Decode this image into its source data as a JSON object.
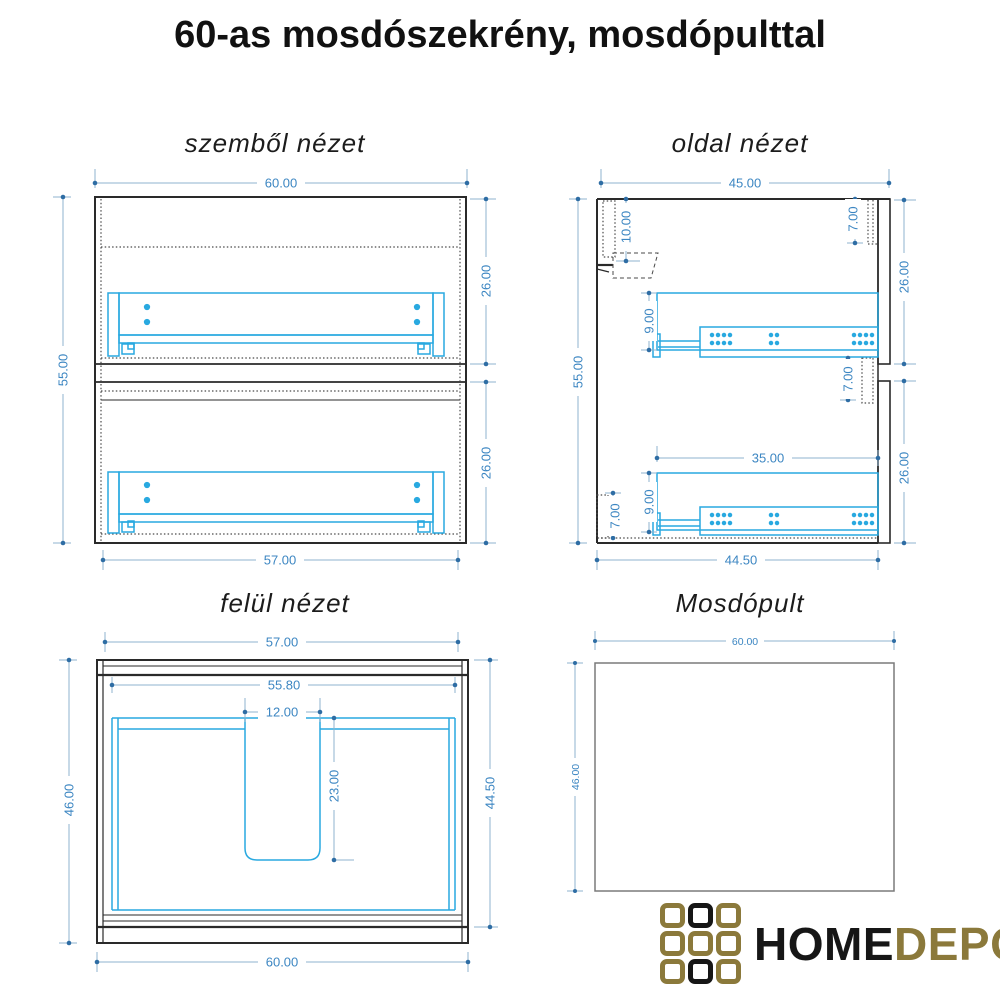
{
  "page_title": "60-as mosdószekrény, mosdópulttal",
  "views": {
    "front": {
      "title": "szemből nézet",
      "dims": {
        "width_top": "60.00",
        "height_left": "55.00",
        "drawer_upper_right": "26.00",
        "drawer_lower_right": "26.00",
        "width_bottom": "57.00"
      }
    },
    "side": {
      "title": "oldal nézet",
      "dims": {
        "depth_top": "45.00",
        "height_left": "55.00",
        "hanger_offset": "10.00",
        "front_top_overlap": "7.00",
        "drawer_upper_right": "26.00",
        "rail_upper": "9.00",
        "front_mid_gap": "7.00",
        "drawer_lower_right": "26.00",
        "drawer_depth": "35.00",
        "rail_lower": "9.00",
        "plinth_height": "7.00",
        "depth_bottom": "44.50"
      }
    },
    "top": {
      "title": "felül nézet",
      "dims": {
        "width_top": "57.00",
        "inner_width": "55.80",
        "cutout_width": "12.00",
        "cutout_depth": "23.00",
        "depth_left": "46.00",
        "depth_right": "44.50",
        "width_bottom": "60.00"
      }
    },
    "counter": {
      "title": "Mosdópult",
      "dims": {
        "width_top": "60.00",
        "depth_left": "46.00"
      }
    }
  },
  "logo": {
    "home": "HOME",
    "depo": "DEPO"
  },
  "colors": {
    "dimension_text": "#3c86c2",
    "dimension_line": "#8fb3cf",
    "dimension_marker": "#2e6da4",
    "drawer_cyan": "#29a9e0",
    "outline_black": "#2a2a2a",
    "counter_outline": "#7a7a7a",
    "logo_gold": "#8b793b",
    "logo_black": "#161616"
  }
}
